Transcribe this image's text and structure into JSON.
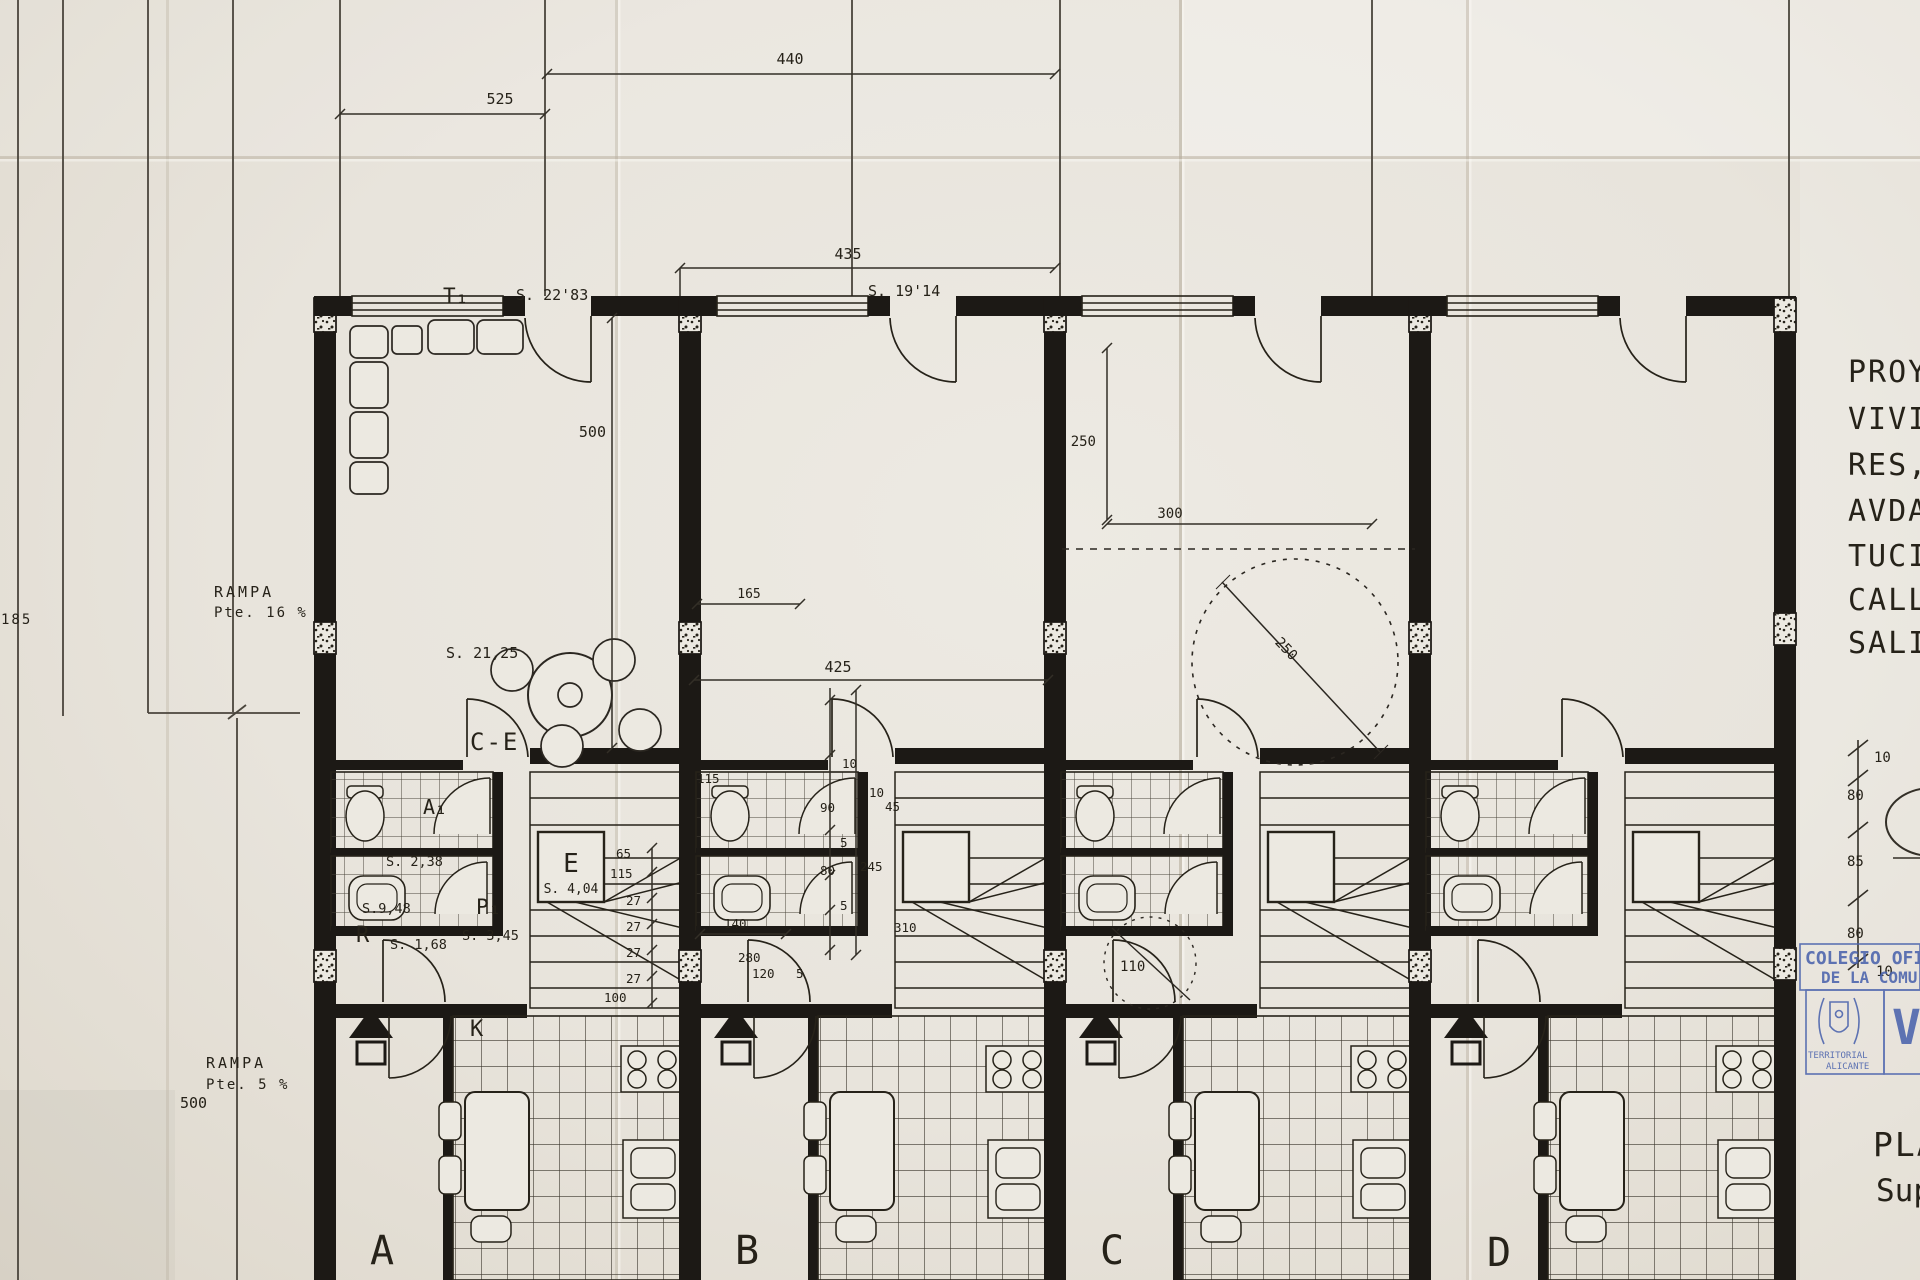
{
  "colors": {
    "paper": "#e8e4dc",
    "ink": "#262219",
    "wall": "#1c1915",
    "stamp_blue": "#4a63ad"
  },
  "site": {
    "rampa_upper": "RAMPA",
    "rampa_upper_slope": "Pte. 16 %",
    "rampa_lower": "RAMPA",
    "rampa_lower_slope": "Pte. 5 %",
    "dim_185": "185",
    "dim_500": "500"
  },
  "top_dims": {
    "d525": "525",
    "d440": "440",
    "d435": "435"
  },
  "unit_a": {
    "letter": "A",
    "type": "T₁",
    "type_area": "S. 22'83",
    "living_area": "S. 21,25",
    "door": "C-E",
    "bath": "A₁",
    "bath_area": "S. 2,38",
    "hall": "P₁",
    "hall_area": "S. 3,45",
    "store": "R",
    "store_area": "S. 1,68",
    "kitchen": "K",
    "kitchen_area": "S.9,48",
    "stair": "E",
    "stair_area": "S. 4,04",
    "depth": "500",
    "stair_dims": {
      "d65": "65",
      "d115": "115",
      "d27_1": "27",
      "d27_2": "27",
      "d27_3": "27",
      "d27_4": "27",
      "d100": "100"
    }
  },
  "unit_b": {
    "letter": "B",
    "area": "S. 19'14",
    "dims": {
      "d425": "425",
      "d165": "165",
      "d10": "10",
      "d90": "90",
      "d5a": "5",
      "d80": "80",
      "d5b": "5",
      "d245": "245",
      "d115": "115",
      "d140": "140",
      "d120": "120",
      "d5c": "5",
      "d10b": "10",
      "d45": "45",
      "d310": "310",
      "d280": "280"
    }
  },
  "unit_c": {
    "letter": "C",
    "dims": {
      "d250_v": "250",
      "d300": "300",
      "d250_r": "250",
      "d110": "110"
    }
  },
  "unit_d": {
    "letter": "D"
  },
  "margin": {
    "project_lines": [
      "PROYE",
      "VIVIEN",
      "RES,",
      "AVDA.",
      "TUCIO",
      "CALLE",
      "SALIN"
    ],
    "section_dims": {
      "d10_top": "10",
      "d80_a": "80",
      "d85": "85",
      "d80_b": "80",
      "d10_bot": "10"
    },
    "stamp": {
      "line1": "COLEGIO OFICI",
      "line2": "DE LA COMU",
      "sub1": "TERRITORIAL",
      "sub2": "ALICANTE",
      "letter": "V"
    },
    "footer": {
      "plan": "PLA",
      "sup": "Sup"
    }
  }
}
